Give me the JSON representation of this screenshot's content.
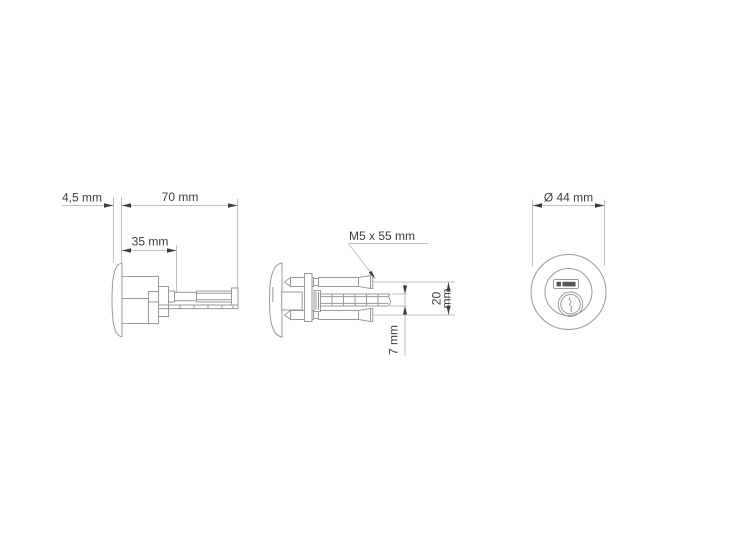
{
  "drawing": {
    "title": "lock-cylinder-technical-drawing",
    "colors": {
      "line": "#9a9a9a",
      "dimension": "#c0c0c0",
      "accent": "#3d3d3d",
      "logo": "#555555",
      "background": "#ffffff"
    },
    "views": {
      "side": {
        "plate_thickness": "4,5 mm",
        "overall_length": "70 mm",
        "body_length": "35 mm"
      },
      "top": {
        "screw_spec": "M5 x 55 mm",
        "screw_spacing_value": "20",
        "screw_spacing_unit": "mm",
        "spindle_diameter": "7 mm"
      },
      "front": {
        "face_diameter": "Ø 44 mm"
      }
    }
  }
}
